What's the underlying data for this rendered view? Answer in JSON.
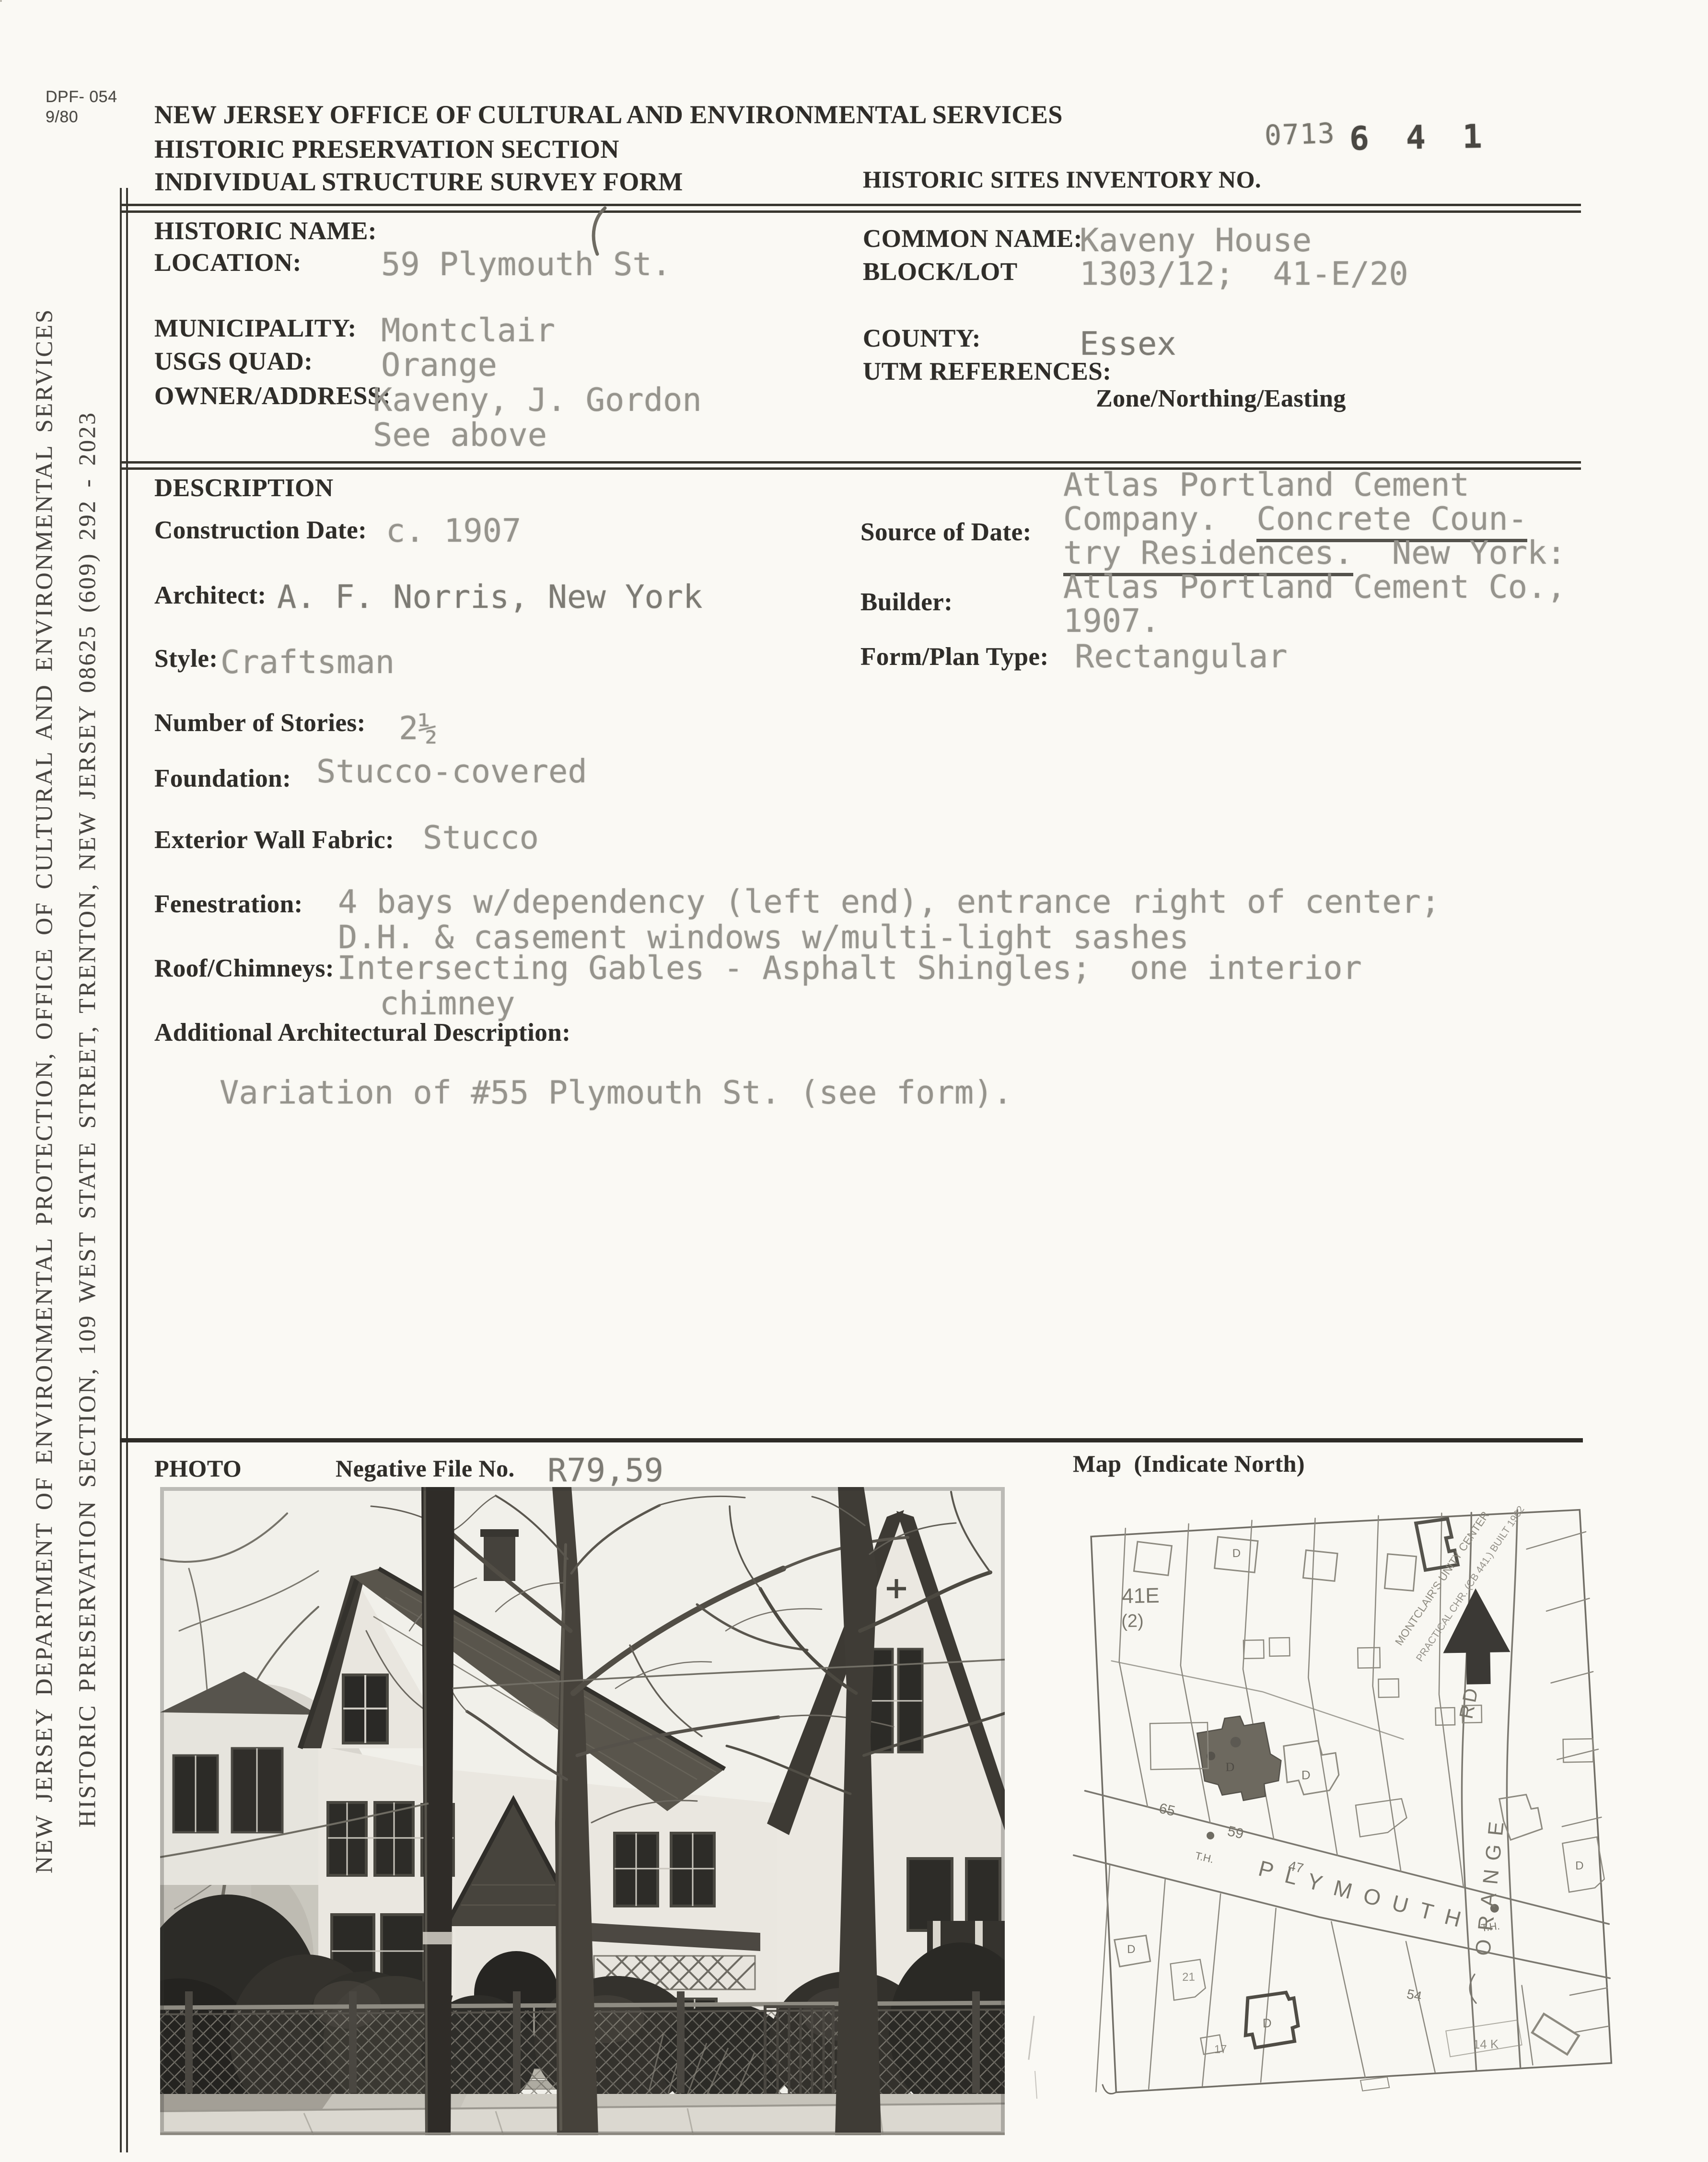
{
  "form_header": {
    "form_no": "DPF- 054",
    "form_date": "9/80",
    "agency_line1": "NEW JERSEY OFFICE OF CULTURAL AND ENVIRONMENTAL SERVICES",
    "agency_line2": "HISTORIC PRESERVATION SECTION",
    "agency_line3": "INDIVIDUAL STRUCTURE SURVEY FORM",
    "inventory_label": "HISTORIC SITES INVENTORY NO.",
    "stamp_prefix": "0713",
    "stamp_number": "6 4 1"
  },
  "sidebar": {
    "line1": "NEW JERSEY DEPARTMENT OF ENVIRONMENTAL PROTECTION, OFFICE OF CULTURAL AND ENVIRONMENTAL SERVICES",
    "line2": "HISTORIC PRESERVATION SECTION, 109 WEST STATE STREET, TRENTON, NEW JERSEY  08625   (609) 292 - 2023"
  },
  "identification": {
    "historic_name_label": "HISTORIC NAME:",
    "historic_name_value": "",
    "location_label": "LOCATION:",
    "location_value": "59 Plymouth St.",
    "municipality_label": "MUNICIPALITY:",
    "municipality_value": "Montclair",
    "usgs_quad_label": "USGS QUAD:",
    "usgs_quad_value": "Orange",
    "owner_label": "OWNER/ADDRESS:",
    "owner_value_line1": "Kaveny, J. Gordon",
    "owner_value_line2": "See above",
    "common_name_label": "COMMON NAME:",
    "common_name_value": "Kaveny House",
    "block_lot_label": "BLOCK/LOT",
    "block_lot_value": "1303/12;  41-E/20",
    "county_label": "COUNTY:",
    "county_value": "Essex",
    "utm_label": "UTM REFERENCES:",
    "utm_sub_label": "Zone/Northing/Easting"
  },
  "description": {
    "section_title": "DESCRIPTION",
    "construction_date_label": "Construction Date:",
    "construction_date_value": "c. 1907",
    "source_label": "Source of Date:",
    "source_line1": "Atlas Portland Cement",
    "source_line2a": "Company.  ",
    "source_line2b": "Concrete Coun-",
    "source_line3a": "try Residences.",
    "source_line3b": "  New York:",
    "source_line4": "Atlas Portland Cement Co.,",
    "source_line5": "1907.",
    "architect_label": "Architect:",
    "architect_value": "A. F. Norris, New York",
    "builder_label": "Builder:",
    "style_label": "Style:",
    "style_value": "Craftsman",
    "form_plan_label": "Form/Plan Type:",
    "form_plan_value": "Rectangular",
    "stories_label": "Number of Stories:",
    "stories_value": "2½",
    "foundation_label": "Foundation:",
    "foundation_value": "Stucco-covered",
    "wall_label": "Exterior Wall Fabric:",
    "wall_value": "Stucco",
    "fenestration_label": "Fenestration:",
    "fenestration_line1": "4 bays w/dependency (left end), entrance right of center;",
    "fenestration_line2": "D.H. & casement windows w/multi-light sashes",
    "roof_label": "Roof/Chimneys:",
    "roof_line1": "Intersecting Gables - Asphalt Shingles;  one interior",
    "roof_line2": "chimney",
    "additional_label": "Additional Architectural Description:",
    "additional_value": "Variation of #55 Plymouth St. (see form)."
  },
  "photo_section": {
    "photo_label": "PHOTO",
    "negative_label": "Negative File No.",
    "negative_value": "R79,59",
    "map_label": "Map  (Indicate North)"
  },
  "map": {
    "street": "PLYMOUTH",
    "road": "ORANGE",
    "road_suffix": "RD",
    "block_no": "41E",
    "block_sub": "(2)",
    "num_65": "65",
    "num_59": "59",
    "num_47": "47",
    "num_54": "54",
    "hydrant": "T.H.",
    "dwelling": "D",
    "lot_21": "21",
    "lot_17": "17",
    "lot_14k": "14 K",
    "note1": "MONTCLAIR'S UNITY CENTER",
    "note2": "PRACTICAL CHR. (CB 441.) BUILT 1962"
  }
}
